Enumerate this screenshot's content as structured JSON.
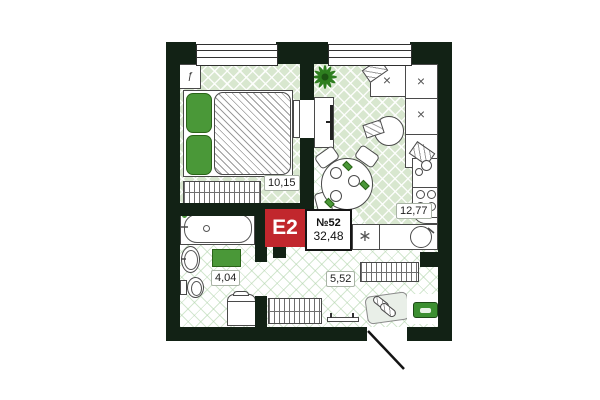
{
  "unit": {
    "type_label": "E2",
    "number_label": "№52",
    "total_area_label": "32,48"
  },
  "rooms": [
    {
      "id": "bedroom",
      "area_label": "10,15"
    },
    {
      "id": "kitchen-living-room",
      "area_label": "12,77"
    },
    {
      "id": "bathroom",
      "area_label": "4,04"
    },
    {
      "id": "hallway",
      "area_label": "5,52"
    }
  ],
  "icons": {
    "cushion_mark": "×",
    "hob_mark": "∗",
    "radiator_mark": "ƒ"
  },
  "colors": {
    "wall": "#122215",
    "floor_green": "#d8e7cf",
    "accent_green": "#4a9838",
    "badge_red": "#c1272d",
    "badge_text": "#ffffff"
  }
}
